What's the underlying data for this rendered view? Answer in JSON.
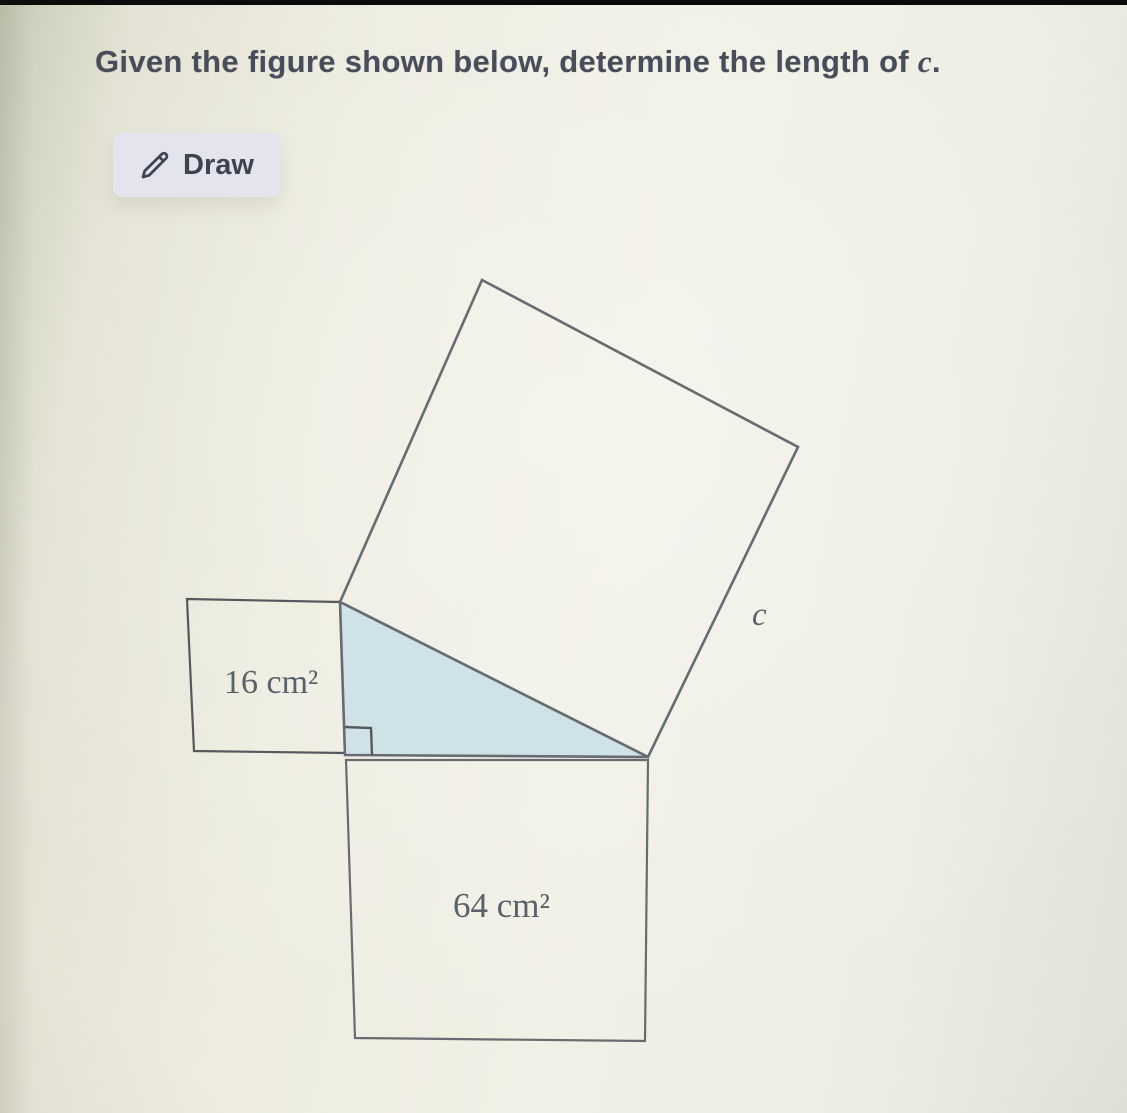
{
  "question": {
    "title_prefix": "Given the figure shown below, determine the length of ",
    "title_variable": "c",
    "title_suffix": "."
  },
  "toolbar": {
    "draw_label": "Draw",
    "draw_icon": "pencil-icon"
  },
  "figure": {
    "small_square_label": "16 cm²",
    "bottom_square_label": "64 cm²",
    "hypotenuse_label": "c",
    "colors": {
      "triangle_fill": "#cfe2e8",
      "line": "#686b71",
      "line_dark": "#55585e",
      "label_text": "#5a616b",
      "title_text": "#484d5a",
      "button_bg": "#e4e4ee",
      "button_text": "#3e4350",
      "background": "#f0efe5"
    }
  }
}
